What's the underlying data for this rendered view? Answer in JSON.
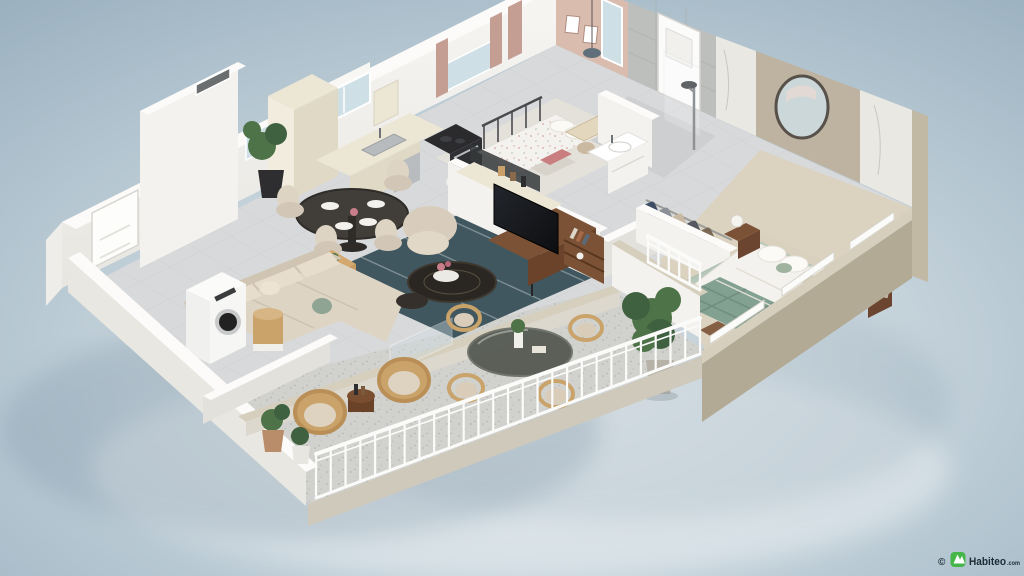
{
  "watermark": {
    "copyright": "©",
    "brand": "Habiteo",
    "tld": ".com"
  },
  "colors": {
    "bg_center": "#e6ecef",
    "bg_edge": "#97adbc",
    "shadow": "#70889b",
    "wall_face": "#f3f2ee",
    "wall_top": "#fcfbf9",
    "wall_shade": "#e3e1db",
    "wall_taupe": "#b3aa96",
    "wall_taupe_top": "#d6cfbd",
    "tile_floor": "#d8d9da",
    "tile_line": "#c3c5c7",
    "terrace_floor": "#d1d2ce",
    "wood_floor": "#dbd2c0",
    "rug_teal": "#41575f",
    "rug_sage": "#b7c8bb",
    "rug_white": "#f1f0ed",
    "tile_wall_gray": "#bcbfbc",
    "marble": "#eae8e2",
    "panel_greige": "#bdb3a0",
    "accent_pink": "#d9bcae",
    "curtain_pink": "#c49d93",
    "glass": "#cfdfe6",
    "kitchen_cabinet": "#ece6d5",
    "kitchen_cabinet_face": "#e0d9c5",
    "appliance_dark": "#2b2b2e",
    "wood_oak": "#d2a86f",
    "wood_walnut": "#7b5236",
    "wicker": "#c9a36a",
    "sofa_beige": "#ded4c4",
    "cushion_sage": "#8fa493",
    "bedding_white": "#f4f2ee",
    "plaid_green": "#83a191",
    "plant_green": "#4e7348",
    "plant_dark": "#3f6140",
    "railing_white": "#fbfbfa",
    "habiteo_green": "#45b649",
    "watermark_ink": "#1c2b33"
  },
  "scene": {
    "description": "3D isometric cutaway floor plan render of a furnished one-bedroom-plus apartment with wrap-around terrace, viewed from above on a blue-grey backdrop",
    "rooms": [
      {
        "name": "entrance-kitchen",
        "items": [
          "entry-door",
          "tall-cabinet",
          "kitchen-counter",
          "sink",
          "dishwasher",
          "cooktop",
          "oven",
          "kitchen-window",
          "potted-plant",
          "round-dining-table",
          "dining-chairs"
        ]
      },
      {
        "name": "living-room",
        "items": [
          "sectional-sofa",
          "teal-rug",
          "coffee-tables",
          "armchair",
          "tv-console",
          "tv",
          "bookshelf",
          "oak-console",
          "washing-machine",
          "laundry-basket"
        ]
      },
      {
        "name": "bedroom-1",
        "items": [
          "metal-frame-bed",
          "floral-duvet",
          "pink-accent-wall",
          "pink-curtains",
          "wall-frames",
          "pendant-lamp",
          "round-rug",
          "desk"
        ]
      },
      {
        "name": "bathroom",
        "items": [
          "tiled-wall",
          "bathroom-door",
          "bathroom-window",
          "shower-column",
          "glass-panel",
          "vanity-sink"
        ]
      },
      {
        "name": "master-bedroom",
        "items": [
          "double-bed",
          "plaid-throw",
          "pillows",
          "nightstands",
          "table-lamps",
          "round-mirror",
          "marble-panels",
          "sage-rug",
          "open-wardrobe",
          "bench"
        ]
      },
      {
        "name": "terrace",
        "items": [
          "white-railing",
          "wicker-armchairs",
          "side-table",
          "outdoor-dining-table",
          "wicker-chairs",
          "potted-plants",
          "parapet-wall"
        ]
      }
    ]
  }
}
